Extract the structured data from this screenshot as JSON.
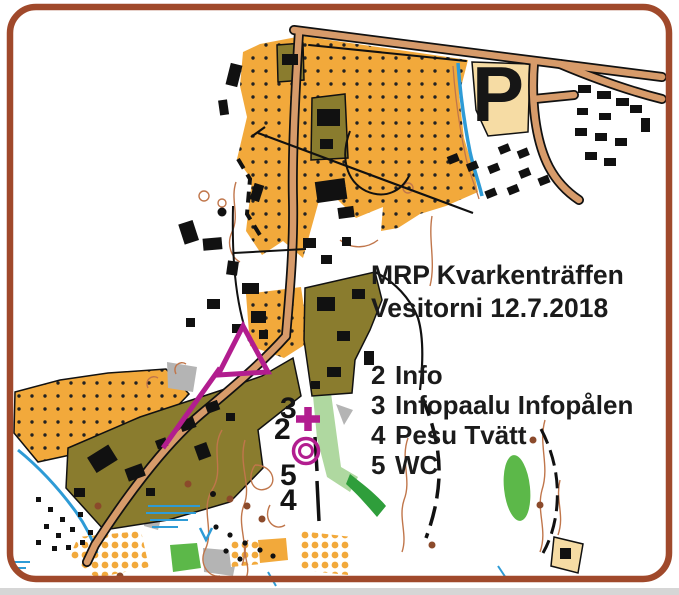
{
  "frame": {
    "border_color": "#A0492B",
    "background_color": "#FFFFFF",
    "footer_bar_color": "#D6D6D6"
  },
  "header": {
    "title_line1": "MRP Kvarkenträffen",
    "title_line2": "Vesitorni 12.7.2018"
  },
  "legend": {
    "items": [
      {
        "number": "2",
        "label": "Info"
      },
      {
        "number": "3",
        "label": "Infopaalu Infopålen"
      },
      {
        "number": "4",
        "label": "Pesu Tvätt"
      },
      {
        "number": "5",
        "label": "WC"
      }
    ]
  },
  "map": {
    "type": "orienteering-event-map",
    "parking_label": "P",
    "control_labels": [
      {
        "number": "3"
      },
      {
        "number": "2"
      },
      {
        "number": "5"
      },
      {
        "number": "4"
      }
    ],
    "colors": {
      "open_land_orange": "#F2A93B",
      "settlement_olive": "#8A7C2E",
      "road_fill": "#D79B6A",
      "water_blue": "#2E9BD6",
      "contour_brown": "#C0764B",
      "vegetation_green": "#5CB849",
      "parking_area": "#F6DCA4",
      "building_black": "#111111",
      "course_overprint_magenta": "#B21D8F"
    }
  }
}
